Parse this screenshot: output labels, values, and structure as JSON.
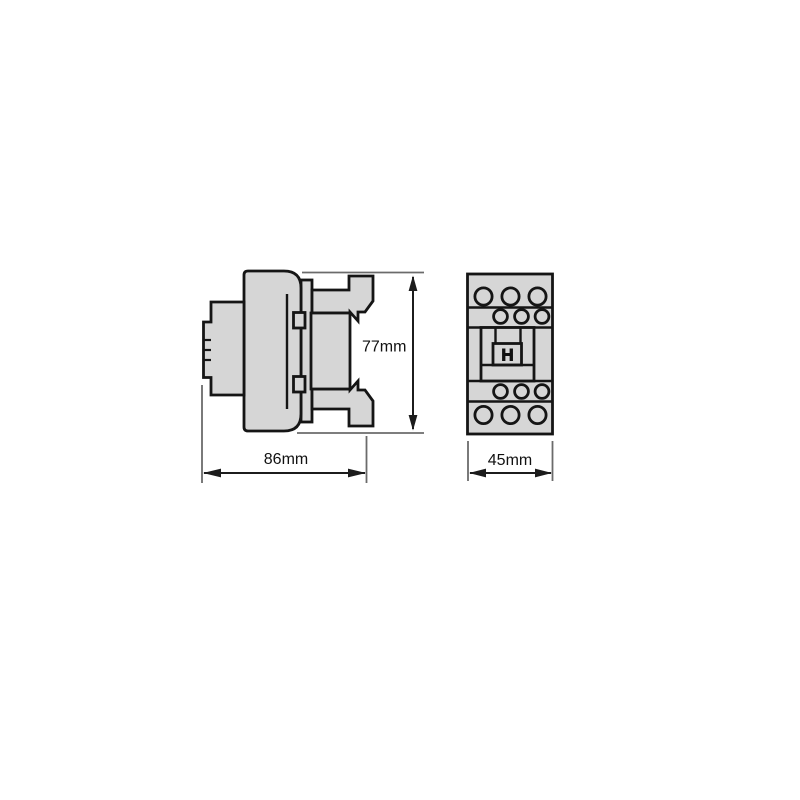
{
  "drawing": {
    "kind": "technical-dimension-drawing",
    "subject": "contactor-outline-views",
    "colors": {
      "background": "#ffffff",
      "device_fill": "#d6d6d6",
      "outline": "#151515",
      "dimension_line": "#1c1c1c",
      "extension_line": "#6b6b6b",
      "label_text": "#111111"
    },
    "views": {
      "side": {
        "height_label": "77mm",
        "width_label": "86mm"
      },
      "front": {
        "depth_label": "45mm",
        "marking": "H"
      }
    }
  }
}
